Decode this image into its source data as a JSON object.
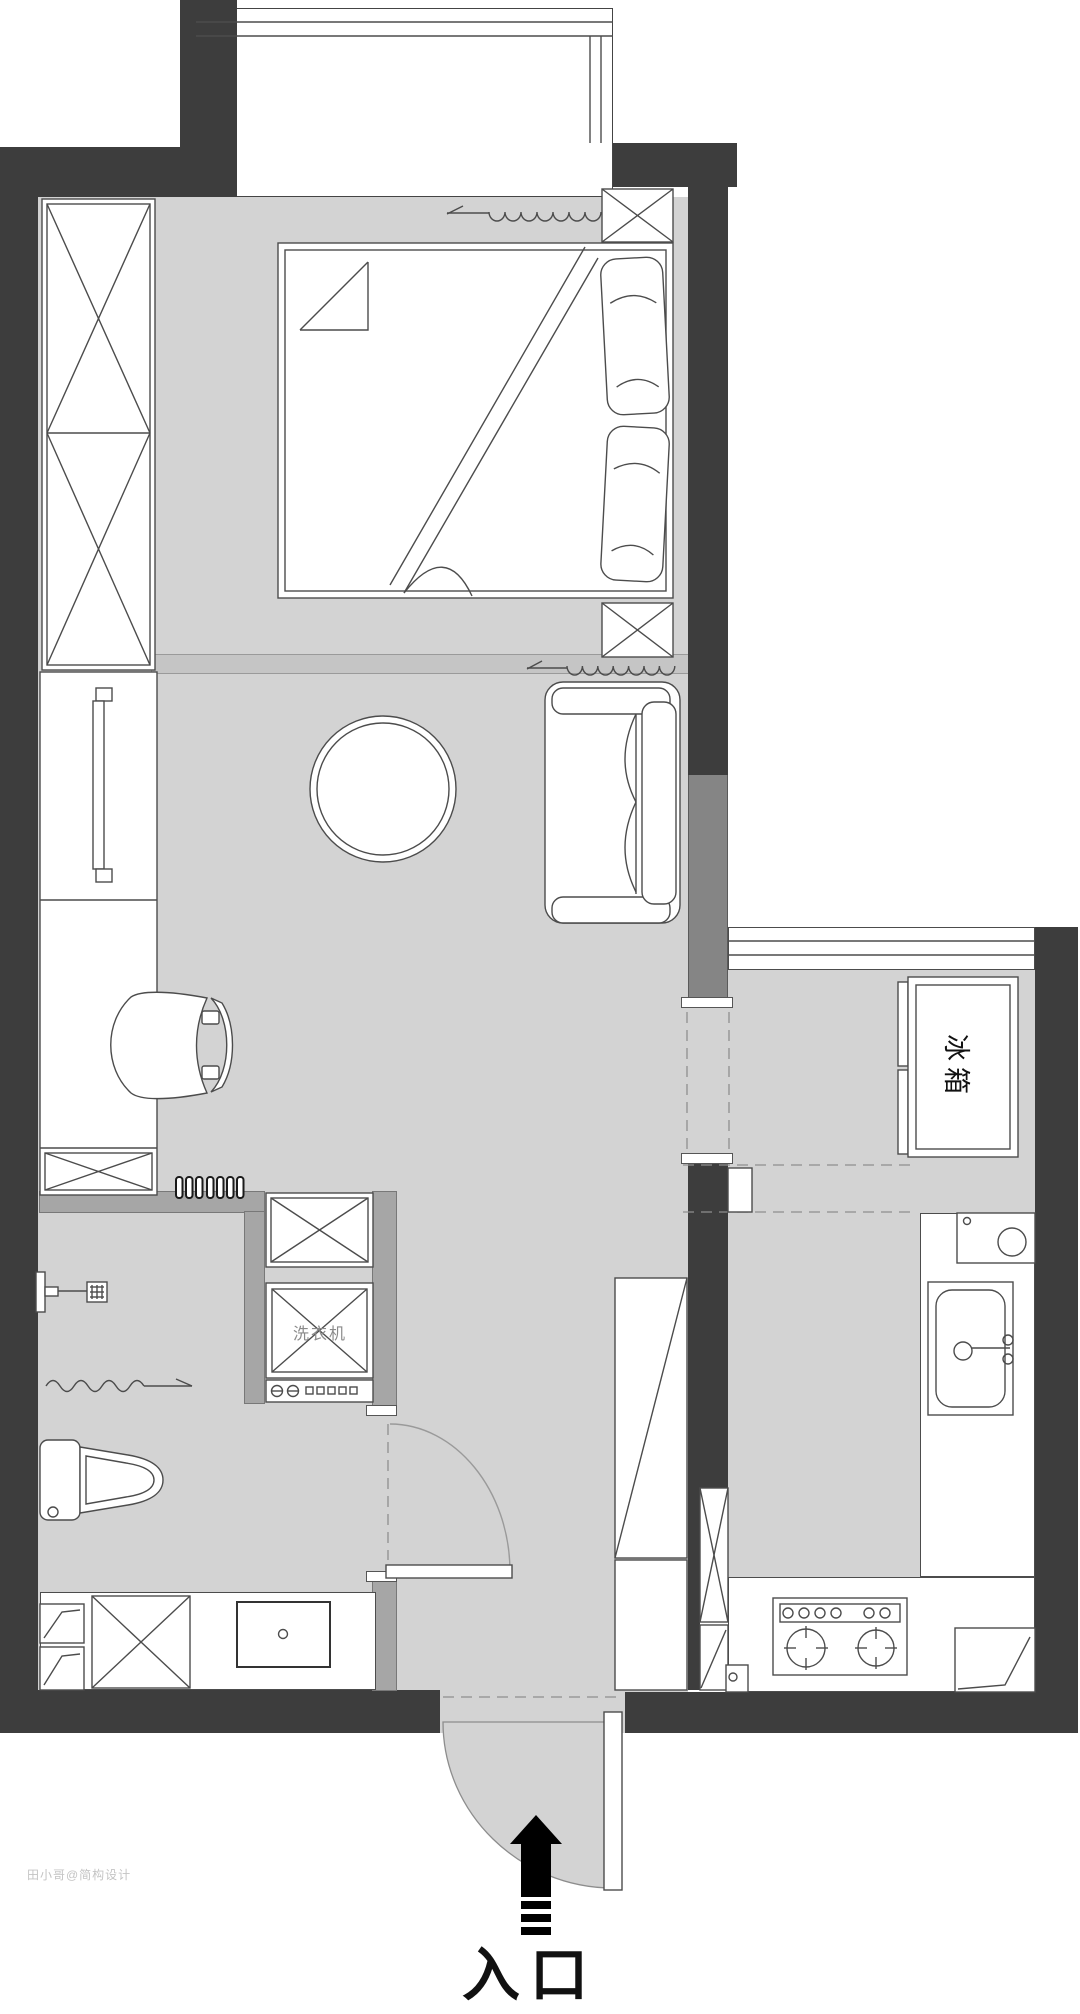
{
  "labels": {
    "entrance": "入口",
    "fridge": "冰箱",
    "washing_machine": "洗衣机",
    "watermark": "田小哥@简构设计"
  },
  "colors": {
    "wall-dark": "#3d3d3d",
    "wall-medium": "#858585",
    "wall-partition": "#a6a6a6",
    "floor": "#d3d3d3",
    "threshold": "#c5c5c5",
    "line": "#4c4c4c",
    "paper": "#ffffff"
  }
}
